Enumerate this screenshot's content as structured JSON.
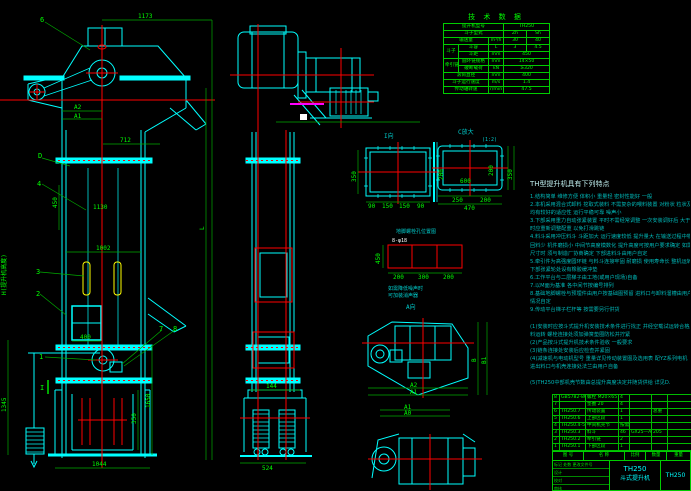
{
  "colors": {
    "cyan": "#00ffff",
    "green": "#00ff00",
    "red": "#ff0000",
    "yellow": "#ffff00",
    "magenta": "#ff00ff",
    "white": "#ffffff",
    "bg": "#000000"
  },
  "tech_table": {
    "title": "技 术 数 据",
    "r1c1": "提升机型号",
    "r1v": "TH250",
    "r2c1": "斗子型式",
    "r2a": "Zh",
    "r2b": "Sh",
    "r3c1": "输送量",
    "r3u": "m³/h",
    "r3a": "30",
    "r3b": "40",
    "g1": "斗子",
    "r4c1": "斗容",
    "r4u": "L",
    "r4a": "3",
    "r4b": "4.5",
    "r5c1": "斗距",
    "r5u": "mm",
    "r5v": "450",
    "g2": "牵引链",
    "r6c1": "圆环链规格",
    "r6u": "mm",
    "r6v": "14×50",
    "r7c1": "破断载荷",
    "r7u": "kN",
    "r7v": "≥320",
    "r8c1": "滚筒直径",
    "r8u": "mm",
    "r8v": "400",
    "r9c1": "斗子运行速度",
    "r9u": "m/s",
    "r9v": "1.4",
    "r10c1": "传动轴转速",
    "r10u": "r/min",
    "r10v": "47.5"
  },
  "features": {
    "title": "TH型提升机具有下列特点",
    "lines": [
      "1.结构简单 维修方便 体积小 重量轻 密封性能好 一般",
      "2.本机采用混合式卸料 挖取式装料 不需复杂的喂料装置 对粉状 粒状及小块物料",
      "  均有较好的适应性 运行平稳可靠 噪声小",
      "3.下部采用重力自动张紧装置 平时不需经常调整 一次安装调好后 大于张紧行程",
      "  时应重新调整配重 以免打滑跳链",
      "4.料斗采用冲压料斗 斗距加大 运行速度较低 提升量大 在输送过程中物料无洒落",
      "  回料少 机件磨损小 中间节高度模数化 提升高度可按用户要求确定 如需更改",
      "  尺寸时 须与制造厂协商确定 下部进料斗由用户自定",
      "5.牵引件为高强度圆环链 与料斗连接牢固 耐磨损 使用寿命长 整机运转噪声小",
      "  下部张紧轮处设有橡胶缓冲垫",
      "6.工作平台与二层梯子由工地(或用户现场)自备",
      "7.以M面为基准 各中间节按编号排列",
      "8.基础地脚螺栓与预埋件由用户按基础图预留 进料口与卸料溜槽由用户根据现场",
      "  情况自定",
      "9.传动平台梯子栏杆等 按需要另行供货",
      "",
      "(1)安装时应按斗式提升机安装技术条件进行找正 并经空载试运转合格后方可投",
      "   料运转 螺栓连接处须加弹簧垫圈防松并拧紧",
      "(2)产品按斗式提升机技术条件验收 一般要求",
      "(3)链条连接处安装后应检查并紧固",
      "(4)减速机与电动机型号 重量详见传动装置图及选用表 配YZ系列电机",
      "   进出料口与机壳连接处法兰由用户自备",
      "",
      "(5)TH250中部机壳节数由总提升高度决定并随货供给 详见D."
    ]
  },
  "bom": {
    "rows": [
      [
        "8",
        "GB5782-86",
        "螺栓 M20×65",
        "4",
        "",
        "",
        ""
      ],
      [
        "7",
        "",
        "垫圈 20",
        "4",
        "",
        "",
        ""
      ],
      [
        "6",
        "TH250.7",
        "传动装置",
        "1",
        "",
        "总重",
        ""
      ],
      [
        "5",
        "TH250.6",
        "上部区段",
        "1",
        "",
        "",
        ""
      ],
      [
        "4",
        "TH250.4-5",
        "中间机壳节",
        "按需",
        "",
        "",
        ""
      ],
      [
        "3",
        "TH250.3",
        "料斗",
        "46",
        "GX25—A",
        "205",
        ""
      ],
      [
        "2",
        "TH250.2",
        "牵引链",
        "2",
        "",
        "",
        ""
      ],
      [
        "1",
        "TH250.1",
        "下部区段",
        "1",
        "",
        "",
        ""
      ]
    ]
  },
  "title_block": {
    "h_code": "图 号",
    "h_name": "名 称",
    "h_scale": "比例",
    "h_qty": "数量",
    "h_weight": "重量",
    "l1": "标记 处数 更改文件号",
    "l2": "设计",
    "l3": "校对",
    "l4": "审核",
    "model": "TH250",
    "name": "斗式提升机",
    "dwg_no": "TH250"
  },
  "dims": {
    "d1173": "1173",
    "a2": "A2",
    "a1": "A1",
    "d712": "712",
    "d450": "450",
    "d1130": "1130",
    "d1002": "1002",
    "d400": "400",
    "d1044": "1044",
    "d1345": "1345",
    "d350": "350",
    "d1650": "1650",
    "dL": "L",
    "dH": "H(提升机高度)",
    "d144": "144",
    "d524": "524",
    "i350": "350",
    "i200": "200",
    "ib1": "90",
    "ib2": "150",
    "ib3": "150",
    "ib4": "90",
    "c600": "600",
    "c200": "200",
    "c350": "350",
    "c250": "250",
    "c200b": "200",
    "c470": "470",
    "an450": "450",
    "an200a": "200",
    "an300": "300",
    "an200b": "200",
    "pB": "B",
    "pB1": "B1",
    "pA2": "A2",
    "pA1": "A1",
    "pA1b": "A1",
    "pA0": "A0"
  },
  "labels": {
    "p1": "1",
    "p2": "2",
    "p3": "3",
    "p4": "4",
    "p6": "6",
    "p7": "7",
    "p8": "8",
    "lblD": "D",
    "secI": "I",
    "viewI": "I向",
    "viewC": "C放大",
    "viewCscale": "(1:2)",
    "anchorTitle": "地脚螺栓孔位置图",
    "anchorBolt": "8-φ18",
    "anchorSub1": "如需降低噪声时",
    "anchorSub2": "可加装消声器",
    "viewA": "A向"
  }
}
